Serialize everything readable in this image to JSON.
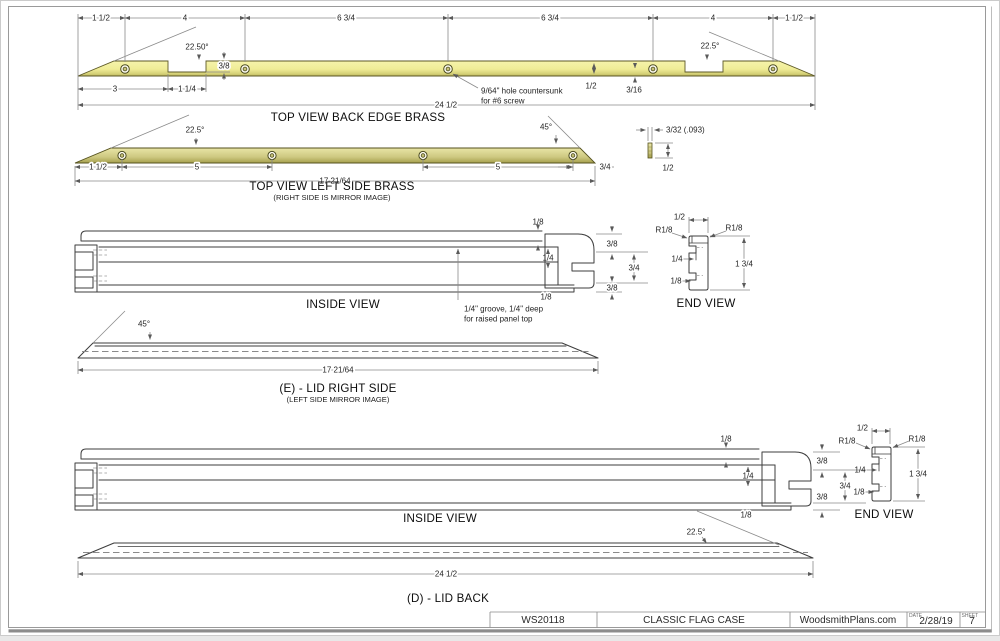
{
  "colors": {
    "brass_light": "#f6f3a9",
    "brass_dark": "#b3ad55",
    "object_line": "#3d3d3d",
    "dim_line": "#8a8a8a"
  },
  "views": {
    "back_edge": {
      "title": "TOP VIEW BACK EDGE BRASS",
      "seg_a": "1 1/2",
      "seg_b": "4",
      "seg_c": "6 3/4",
      "seg_d": "6 3/4",
      "seg_e": "4",
      "seg_f": "1 1/2",
      "angle_left": "22.50°",
      "angle_right": "22.5°",
      "notch_depth": "3/8",
      "left_len": "3",
      "notch_width": "1 1/4",
      "strip_width": "1/2",
      "hole_edge": "3/16",
      "overall": "24 1/2",
      "hole_note_1": "9/64\" hole countersunk",
      "hole_note_2": "for #6 screw"
    },
    "left_side": {
      "title": "TOP VIEW LEFT SIDE BRASS",
      "subtitle": "(RIGHT SIDE IS MIRROR IMAGE)",
      "angle_left": "22.5°",
      "angle_right": "45°",
      "seg_a": "1 1/2",
      "seg_b": "5",
      "seg_c": "5",
      "seg_d": "3/4",
      "overall": "17 21/64"
    },
    "strip_section": {
      "thickness": "3/32 (.093)",
      "width": "1/2"
    },
    "inside_top": {
      "title": "INSIDE VIEW",
      "lip": "1/8",
      "band_top": "3/8",
      "groove_depth": "1/4",
      "body": "3/4",
      "band_bottom": "3/8",
      "lip_bottom": "1/8",
      "groove_note_1": "1/4\" groove, 1/4\" deep",
      "groove_note_2": "for raised panel top"
    },
    "end_top": {
      "title": "END VIEW",
      "width": "1/2",
      "radius_left": "R1/8",
      "radius_right": "R1/8",
      "groove": "1/4",
      "lip": "1/8",
      "height": "1 3/4"
    },
    "lid_right": {
      "title": "(E) - LID RIGHT SIDE",
      "subtitle": "(LEFT SIDE MIRROR IMAGE)",
      "angle": "45°",
      "overall": "17 21/64"
    },
    "inside_bottom": {
      "title": "INSIDE VIEW",
      "lip": "1/8",
      "band_top": "3/8",
      "groove_depth": "1/4",
      "body": "3/4",
      "band_bottom": "3/8",
      "lip_bottom": "1/8"
    },
    "end_bottom": {
      "title": "END VIEW",
      "width": "1/2",
      "radius_left": "R1/8",
      "radius_right": "R1/8",
      "groove": "1/4",
      "lip": "1/8",
      "height": "1 3/4"
    },
    "lid_back": {
      "title": "(D) - LID BACK",
      "angle": "22.5°",
      "overall": "24 1/2"
    }
  },
  "title_block": {
    "part_number": "WS20118",
    "project": "CLASSIC FLAG CASE",
    "source": "WoodsmithPlans.com",
    "date_label": "DATE",
    "date": "2/28/19",
    "sheet_label": "SHEET",
    "sheet": "7"
  }
}
